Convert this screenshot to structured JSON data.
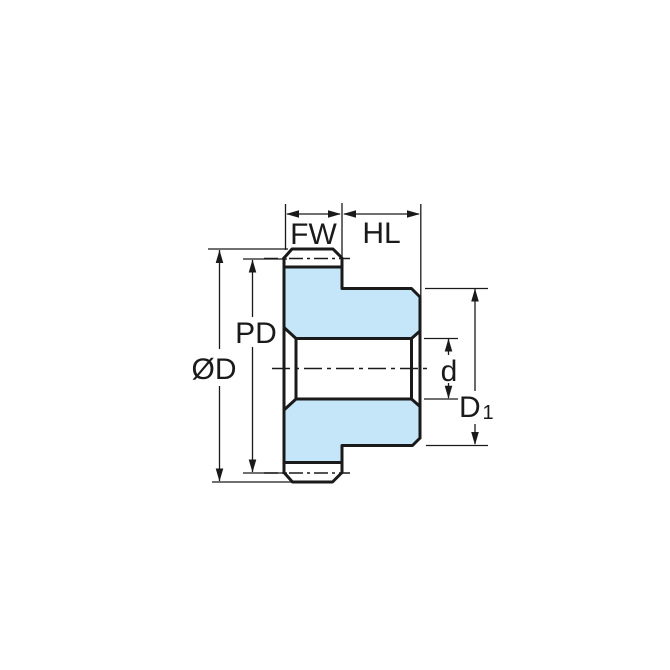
{
  "labels": {
    "face_width": "FW",
    "hub_length": "HL",
    "outer_diameter": "ØD",
    "pitch_diameter": "PD",
    "bore_diameter": "d",
    "hub_diameter_base": "D",
    "hub_diameter_sub": "1"
  },
  "colors": {
    "gear_fill": "#C4E6F8",
    "line_color": "#1A1A1A",
    "background": "#FFFFFF"
  }
}
